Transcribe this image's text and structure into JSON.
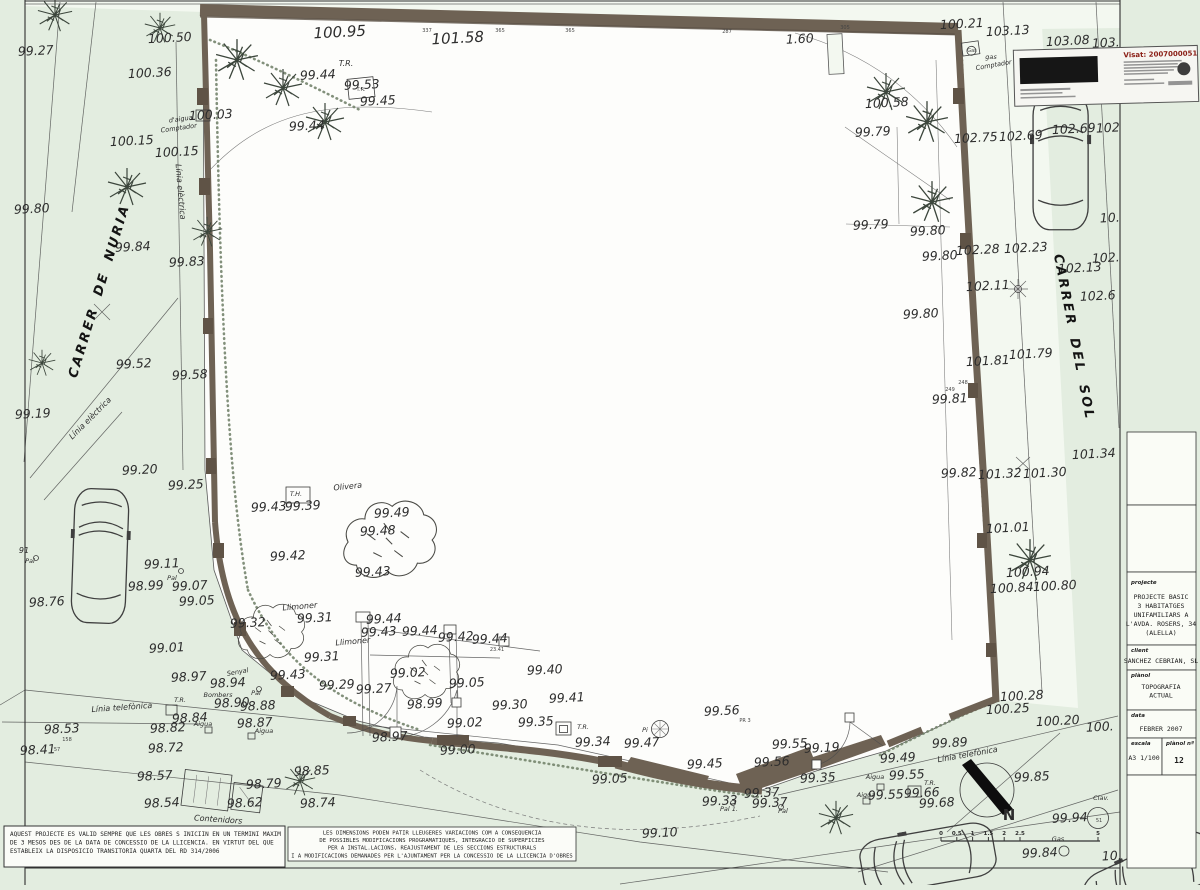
{
  "title_block": {
    "fields": [
      {
        "label": "projecte",
        "lines": [
          "PROJECTE BASIC",
          "3 HABITATGES",
          "UNIFAMILIARS A",
          "L'AVDA. ROSERS, 34",
          "(ALELLA)"
        ]
      },
      {
        "label": "client",
        "lines": [
          "SANCHEZ CEBRIAN, SL"
        ]
      },
      {
        "label": "plànol",
        "lines": [
          "TOPOGRAFIA",
          "ACTUAL"
        ]
      },
      {
        "label": "data",
        "lines": [
          "FEBRER  2007"
        ]
      },
      {
        "label": "escala",
        "lines": [
          "A3 1/100"
        ]
      },
      {
        "label": "plànol nº",
        "lines": [
          "12"
        ]
      }
    ]
  },
  "stamp": {
    "visat": "Visat: 2007000051"
  },
  "notes": {
    "validity": [
      "AQUEST PROJECTE ES VALID SEMPRE QUE LES OBRES S INICIIN EN UN TERMINI MAXIM",
      "DE 3 MESOS DES DE LA DATA DE CONCESSIO DE LA LLICENCIA. EN VIRTUT DEL QUE",
      "ESTABLEIX LA DISPOSICIO TRANSITORIA QUARTA DEL RD 314/2006"
    ],
    "dimensions": [
      "LES DIMENSIONS PODEN PATIR LLEUGERES VARIACIONS COM A CONSEQUENCIA",
      "DE POSSIBLES MODIFICACIONS PROGRAMATIQUES, INTEGRACIO DE SUPERFICIES",
      "PER A INSTAL.LACIONS, REAJUSTAMENT DE LES SECCIONS ESTRUCTURALS",
      "I A MODIFICACIONS DEMANADES PER L'AJUNTAMENT PER LA CONCESSIO DE LA LLICENCIA D'OBRES"
    ]
  },
  "compass": {
    "label": "N"
  },
  "scale_bar": {
    "ticks": [
      "0",
      "0.5",
      "1",
      "1.5",
      "2",
      "2.5"
    ],
    "end_tick": "5"
  },
  "plan": {
    "streets": [
      "CARRER DE NURIA",
      "CARRER DEL SOL"
    ],
    "labels": [
      [
        36,
        55,
        "99.27"
      ],
      [
        170,
        42,
        "100.50"
      ],
      [
        340,
        37,
        "100.95",
        "xl"
      ],
      [
        458,
        43,
        "101.58",
        "xl"
      ],
      [
        150,
        77,
        "100.36"
      ],
      [
        211,
        119,
        "100.03"
      ],
      [
        132,
        145,
        "100.15"
      ],
      [
        177,
        156,
        "100.15"
      ],
      [
        32,
        213,
        "99.80"
      ],
      [
        133,
        251,
        "99.84"
      ],
      [
        187,
        266,
        "99.83"
      ],
      [
        134,
        368,
        "99.52"
      ],
      [
        190,
        379,
        "99.58"
      ],
      [
        33,
        418,
        "99.19"
      ],
      [
        140,
        474,
        "99.20"
      ],
      [
        186,
        489,
        "99.25"
      ],
      [
        47,
        606,
        "98.76"
      ],
      [
        162,
        568,
        "99.11"
      ],
      [
        146,
        590,
        "98.99"
      ],
      [
        190,
        590,
        "99.07"
      ],
      [
        197,
        605,
        "99.05"
      ],
      [
        167,
        652,
        "99.01"
      ],
      [
        189,
        681,
        "98.97"
      ],
      [
        228,
        687,
        "98.94"
      ],
      [
        24,
        553,
        "91",
        "sm"
      ],
      [
        30,
        563,
        "Pal",
        "xs"
      ],
      [
        172,
        580,
        "Pal",
        "xs"
      ],
      [
        180,
        702,
        "T.R.",
        "xs"
      ],
      [
        122,
        710,
        "Línia telefònica",
        "sm",
        -4
      ],
      [
        92,
        420,
        "Línia elèctrica",
        "sm",
        -45
      ],
      [
        178,
        192,
        "Línia elèctrica",
        "sm",
        85
      ],
      [
        181,
        121,
        "d'aigua",
        "xs",
        -8
      ],
      [
        179,
        130,
        "Comptador",
        "xs",
        -8
      ],
      [
        346,
        66,
        "T.R.",
        "sm"
      ],
      [
        318,
        79,
        "99.44"
      ],
      [
        362,
        89,
        "99.53"
      ],
      [
        378,
        105,
        "99.45"
      ],
      [
        307,
        130,
        "99.44"
      ],
      [
        361,
        91,
        "T.R.",
        "tt"
      ],
      [
        427,
        32,
        "337",
        "tt"
      ],
      [
        500,
        32,
        "365",
        "tt"
      ],
      [
        570,
        32,
        "365",
        "tt"
      ],
      [
        727,
        33,
        "287",
        "tt"
      ],
      [
        845,
        29,
        "305",
        "tt"
      ],
      [
        296,
        496,
        "T.H.",
        "xs"
      ],
      [
        269,
        511,
        "99.43"
      ],
      [
        303,
        510,
        "99.39"
      ],
      [
        348,
        489,
        "Olivera",
        "sm",
        -6
      ],
      [
        392,
        517,
        "99.49"
      ],
      [
        378,
        535,
        "99.48"
      ],
      [
        373,
        576,
        "99.43"
      ],
      [
        288,
        560,
        "99.42"
      ],
      [
        300,
        609,
        "Llimoner",
        "sm",
        -5
      ],
      [
        353,
        644,
        "Llimoner",
        "sm",
        -5
      ],
      [
        315,
        622,
        "99.31"
      ],
      [
        248,
        627,
        "99.32"
      ],
      [
        322,
        661,
        "99.31"
      ],
      [
        238,
        674,
        "Senyal",
        "xs",
        -10
      ],
      [
        218,
        697,
        "Bombers",
        "xs"
      ],
      [
        256,
        695,
        "Pal",
        "xs"
      ],
      [
        232,
        707,
        "98.90"
      ],
      [
        258,
        710,
        "98.88"
      ],
      [
        62,
        733,
        "98.53"
      ],
      [
        67,
        741,
        "158",
        "tt"
      ],
      [
        38,
        754,
        "98.41"
      ],
      [
        57,
        751,
        "57",
        "tt"
      ],
      [
        190,
        722,
        "98.84"
      ],
      [
        168,
        732,
        "98.82"
      ],
      [
        203,
        726,
        "Aigua",
        "xs"
      ],
      [
        255,
        727,
        "98.87"
      ],
      [
        264,
        733,
        "Aigua",
        "xs"
      ],
      [
        166,
        752,
        "98.72"
      ],
      [
        155,
        780,
        "98.57"
      ],
      [
        162,
        807,
        "98.54"
      ],
      [
        245,
        807,
        "98.62"
      ],
      [
        264,
        788,
        "98.79"
      ],
      [
        312,
        775,
        "98.85"
      ],
      [
        318,
        807,
        "98.74"
      ],
      [
        218,
        822,
        "Contenidors",
        "sm",
        4
      ],
      [
        384,
        623,
        "99.44"
      ],
      [
        379,
        636,
        "99.43"
      ],
      [
        420,
        635,
        "99.44"
      ],
      [
        456,
        641,
        "99.42"
      ],
      [
        490,
        643,
        "99.44"
      ],
      [
        497,
        651,
        "23.41",
        "tt"
      ],
      [
        288,
        679,
        "99.43"
      ],
      [
        337,
        689,
        "99.29"
      ],
      [
        374,
        693,
        "99.27"
      ],
      [
        408,
        677,
        "99.02"
      ],
      [
        425,
        708,
        "98.99"
      ],
      [
        467,
        687,
        "99.05"
      ],
      [
        510,
        709,
        "99.30"
      ],
      [
        465,
        727,
        "99.02"
      ],
      [
        458,
        754,
        "99.00"
      ],
      [
        390,
        741,
        "98.97"
      ],
      [
        545,
        674,
        "99.40"
      ],
      [
        567,
        702,
        "99.41"
      ],
      [
        536,
        726,
        "99.35"
      ],
      [
        583,
        729,
        "T.R.",
        "xs"
      ],
      [
        593,
        746,
        "99.34"
      ],
      [
        642,
        747,
        "99.47"
      ],
      [
        645,
        732,
        "Pi",
        "xs"
      ],
      [
        610,
        783,
        "99.05"
      ],
      [
        705,
        768,
        "99.45"
      ],
      [
        722,
        715,
        "99.56"
      ],
      [
        745,
        722,
        "PR 3",
        "tt"
      ],
      [
        720,
        805,
        "99.33"
      ],
      [
        729,
        811,
        "Pal 1.",
        "xs"
      ],
      [
        762,
        797,
        "99.37"
      ],
      [
        770,
        807,
        "99.37"
      ],
      [
        783,
        813,
        "Pal",
        "xs"
      ],
      [
        660,
        837,
        "99.10"
      ],
      [
        790,
        748,
        "99.55"
      ],
      [
        772,
        766,
        "99.56"
      ],
      [
        822,
        752,
        "99.19"
      ],
      [
        818,
        782,
        "99.35"
      ],
      [
        898,
        762,
        "99.49"
      ],
      [
        907,
        779,
        "99.55"
      ],
      [
        875,
        779,
        "Aigua",
        "xs"
      ],
      [
        886,
        799,
        "99.55"
      ],
      [
        866,
        797,
        "Aigua",
        "xs"
      ],
      [
        922,
        797,
        "99.66"
      ],
      [
        937,
        807,
        "99.68"
      ],
      [
        930,
        785,
        "T.R.",
        "xs"
      ],
      [
        950,
        747,
        "99.89"
      ],
      [
        968,
        757,
        "Línia telefònica",
        "sm",
        -10
      ],
      [
        1032,
        781,
        "99.85"
      ],
      [
        1070,
        822,
        "99.94"
      ],
      [
        1101,
        800,
        "Clav.",
        "xs"
      ],
      [
        1099,
        822,
        "51",
        "tt"
      ],
      [
        1040,
        857,
        "99.84"
      ],
      [
        1058,
        841,
        "Gas",
        "xs"
      ],
      [
        1112,
        860,
        "10."
      ],
      [
        1022,
        700,
        "100.28"
      ],
      [
        1008,
        713,
        "100.25"
      ],
      [
        1058,
        725,
        "100.20"
      ],
      [
        1100,
        731,
        "100."
      ],
      [
        928,
        235,
        "99.80"
      ],
      [
        940,
        260,
        "99.80"
      ],
      [
        978,
        254,
        "102.28"
      ],
      [
        1026,
        252,
        "102.23"
      ],
      [
        1080,
        272,
        "102.13"
      ],
      [
        1106,
        262,
        "102."
      ],
      [
        988,
        290,
        "102.11"
      ],
      [
        1098,
        300,
        "102.6"
      ],
      [
        921,
        318,
        "99.80"
      ],
      [
        988,
        365,
        "101.81"
      ],
      [
        1031,
        358,
        "101.79"
      ],
      [
        950,
        403,
        "99.81"
      ],
      [
        963,
        384,
        "248",
        "tt"
      ],
      [
        950,
        391,
        "249",
        "tt"
      ],
      [
        959,
        477,
        "99.82"
      ],
      [
        1000,
        478,
        "101.32"
      ],
      [
        1045,
        477,
        "101.30"
      ],
      [
        1094,
        458,
        "101.34"
      ],
      [
        1008,
        532,
        "101.01"
      ],
      [
        1028,
        576,
        "100.94"
      ],
      [
        1012,
        592,
        "100.84"
      ],
      [
        1055,
        590,
        "100.80"
      ],
      [
        873,
        136,
        "99.79"
      ],
      [
        871,
        229,
        "99.79"
      ],
      [
        887,
        107,
        "100.58"
      ],
      [
        800,
        43,
        "1.60"
      ],
      [
        962,
        28,
        "100.21"
      ],
      [
        1008,
        35,
        "103.13"
      ],
      [
        1068,
        45,
        "103.08"
      ],
      [
        1106,
        47,
        "103."
      ],
      [
        976,
        142,
        "102.75"
      ],
      [
        1021,
        140,
        "102.69"
      ],
      [
        1074,
        133,
        "102.69"
      ],
      [
        1108,
        132,
        "102"
      ],
      [
        1110,
        222,
        "10."
      ],
      [
        972,
        52,
        "Gas",
        "tt"
      ],
      [
        991,
        59,
        "gas",
        "xs"
      ],
      [
        994,
        67,
        "Comptador",
        "xs",
        -10
      ],
      [
        103,
        292,
        "CARRER DE NURIA",
        "st",
        -73
      ],
      [
        1070,
        338,
        "CARRER DEL SOL",
        "st",
        79
      ]
    ]
  }
}
